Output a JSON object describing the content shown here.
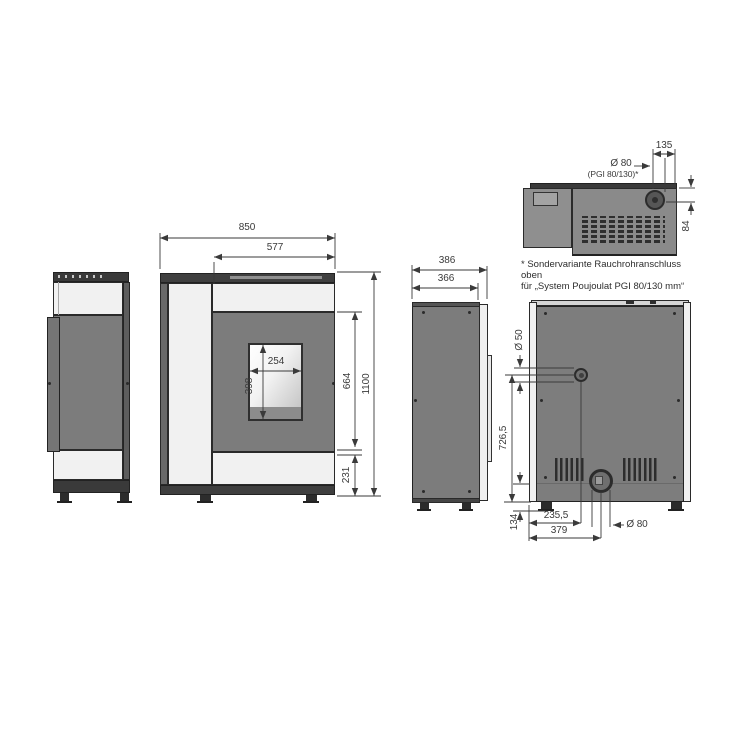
{
  "drawing": {
    "type": "technical-dimension-drawing",
    "subject": "pellet stove shown in side, front, profile, top and rear orthographic views"
  },
  "dims": {
    "front_total_width": "850",
    "front_door_width": "577",
    "front_window_width": "254",
    "front_window_height": "398",
    "front_door_height": "664",
    "front_total_height": "1100",
    "front_base_height": "231",
    "side_total_depth": "386",
    "side_body_depth": "366",
    "top_flue_offset": "135",
    "top_flue_dia": "Ø 80",
    "top_flue_variant": "(PGI 80/130)*",
    "top_flue_center_depth": "84",
    "back_air_dia": "Ø 50",
    "back_air_center_height": "726,5",
    "back_base_height": "134",
    "back_air_center_offset": "235,5",
    "back_flue_center_offset": "379",
    "back_flue_dia": "Ø 80"
  },
  "footnote": {
    "line1": "* Sondervariante Rauchrohranschluss oben",
    "line2": "für „System Poujoulat PGI 80/130 mm“"
  },
  "colors": {
    "panel_gray": "#7c7c7c",
    "panel_light": "#f1f1f1",
    "cap_dark": "#3f3f3f",
    "edge_gray": "#5d5d5d",
    "dimension_line": "#3a3a3a",
    "background": "#ffffff"
  }
}
